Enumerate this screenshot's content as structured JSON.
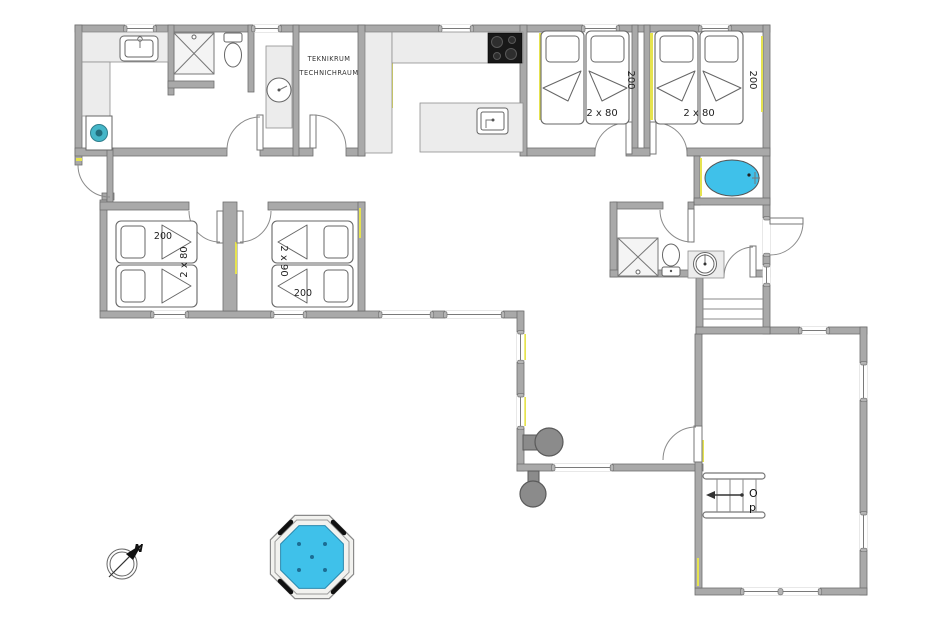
{
  "labels": {
    "technical_room_line1": "TEKNIKRUM",
    "technical_room_line2": "TECHNICHRAUM"
  },
  "bedrooms": {
    "bottom_left": {
      "length": "200",
      "size": "2 x 80"
    },
    "bottom_middle": {
      "size": "2 x 90",
      "length": "200"
    },
    "top_middle": {
      "size": "2 x 80",
      "length": "200"
    },
    "top_right": {
      "size": "2 x 80",
      "length": "200"
    }
  },
  "stairs": {
    "direction_line1": "O",
    "direction_line2": "p"
  },
  "compass": {
    "north_label": "N"
  },
  "colors": {
    "wall_gray": "#a9a9a9",
    "wall_outline": "#6e6e6e",
    "counter_gray": "#ececec",
    "accent_yellow": "#e6e34f",
    "water_blue": "#3fc1ea",
    "cooktop_black": "#181818",
    "stove_gray": "#8b8b8b",
    "washer_teal": "#45b6c8",
    "jet_dark": "#1c6d94"
  }
}
